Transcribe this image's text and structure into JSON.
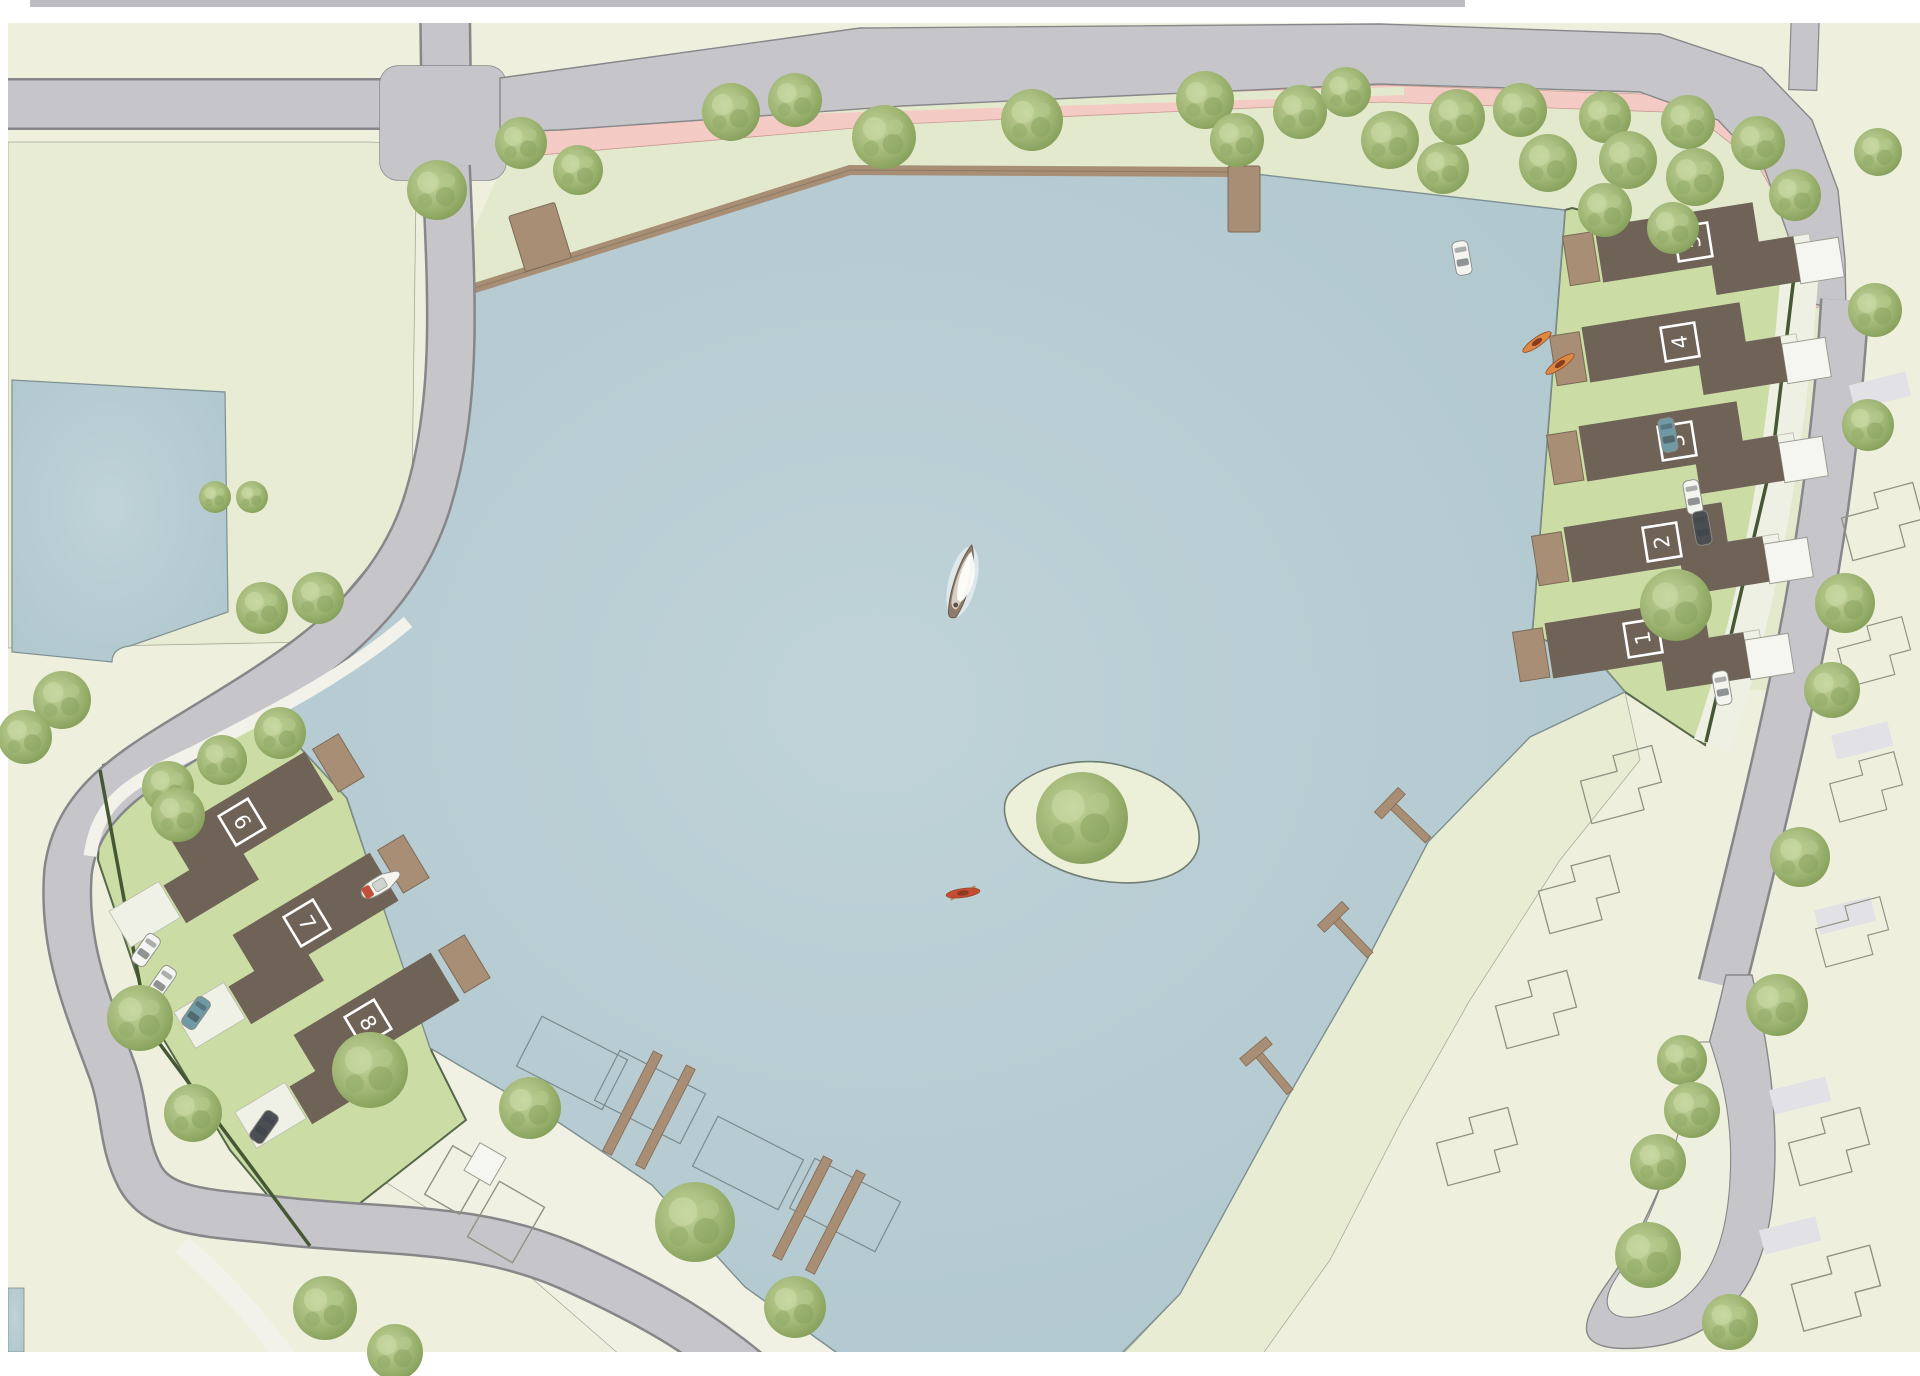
{
  "document": {
    "kind": "architectural site plan",
    "view": "top-down illustrated map of a lake-side housing development",
    "visible_text_labels": [
      "1",
      "2",
      "3",
      "4",
      "5",
      "6",
      "7",
      "8"
    ]
  },
  "palette": {
    "land_base": "#eef0dd",
    "parcel_sage": "#e8ecd4",
    "bank_green": "#e3e9cd",
    "lawn_green": "#cbdda4",
    "quay_pale": "#f0f1e3",
    "water_blue": "#b6ccd2",
    "water_edge": "#7e8f91",
    "road_gray": "#c6c5c9",
    "road_edge": "#87878a",
    "sidewalk": "#f2f2ea",
    "crosswalk": "#e2e2e6",
    "path_pink": "#f4cbc4",
    "house_dark": "#6f6358",
    "jetty_brown": "#a78e74",
    "hedge_dark": "#465833",
    "tree_green": "#9fb573"
  },
  "map": {
    "houses": [
      {
        "label": "5",
        "x": 1693,
        "y": 242,
        "rot": -9,
        "side": "right"
      },
      {
        "label": "4",
        "x": 1680,
        "y": 342,
        "rot": -9,
        "side": "right"
      },
      {
        "label": "3",
        "x": 1677,
        "y": 441,
        "rot": -9,
        "side": "right"
      },
      {
        "label": "2",
        "x": 1662,
        "y": 542,
        "rot": -9,
        "side": "right"
      },
      {
        "label": "1",
        "x": 1643,
        "y": 638,
        "rot": -9,
        "side": "right"
      },
      {
        "label": "6",
        "x": 242,
        "y": 822,
        "rot": -31,
        "side": "left"
      },
      {
        "label": "7",
        "x": 307,
        "y": 923,
        "rot": -31,
        "side": "left"
      },
      {
        "label": "8",
        "x": 368,
        "y": 1023,
        "rot": -31,
        "side": "left"
      }
    ],
    "vehicles": [
      {
        "x": 146,
        "y": 950,
        "rot": -55,
        "color": "#f4f5f1"
      },
      {
        "x": 162,
        "y": 982,
        "rot": -55,
        "color": "#f4f5f1"
      },
      {
        "x": 196,
        "y": 1013,
        "rot": -55,
        "color": "#6f9aa4"
      },
      {
        "x": 264,
        "y": 1127,
        "rot": -55,
        "color": "#4b4f54"
      },
      {
        "x": 1462,
        "y": 258,
        "rot": -100,
        "color": "#f4f5f1"
      },
      {
        "x": 1668,
        "y": 435,
        "rot": -100,
        "color": "#6f9aa4"
      },
      {
        "x": 1693,
        "y": 497,
        "rot": -100,
        "color": "#f4f5f1"
      },
      {
        "x": 1702,
        "y": 528,
        "rot": -100,
        "color": "#4b4f54"
      },
      {
        "x": 1722,
        "y": 688,
        "rot": -100,
        "color": "#f4f5f1"
      }
    ],
    "boats": {
      "sailboat": {
        "x": 963,
        "y": 580,
        "rot": 14
      },
      "motorboat": {
        "x": 381,
        "y": 884,
        "rot": -31
      },
      "kayaks": [
        {
          "x": 963,
          "y": 893,
          "rot": -8,
          "color": "#c64b33",
          "paddle": true
        },
        {
          "x": 1537,
          "y": 342,
          "rot": -35,
          "color": "#dd8840",
          "paddle": false
        },
        {
          "x": 1560,
          "y": 364,
          "rot": -35,
          "color": "#dd8840",
          "paddle": false
        }
      ]
    },
    "t_piers": [
      {
        "x": 1428,
        "y": 840,
        "rot": 224
      },
      {
        "x": 1370,
        "y": 955,
        "rot": 226
      },
      {
        "x": 1290,
        "y": 1092,
        "rot": 230
      }
    ],
    "marina_piers": [
      {
        "x": 607,
        "y": 1153,
        "rot": -63
      },
      {
        "x": 640,
        "y": 1167,
        "rot": -63
      },
      {
        "x": 777,
        "y": 1258,
        "rot": -63
      },
      {
        "x": 810,
        "y": 1272,
        "rot": -63
      }
    ],
    "berth_outlines": [
      {
        "x": 572,
        "y": 1063,
        "rot": -63
      },
      {
        "x": 650,
        "y": 1097,
        "rot": -63
      },
      {
        "x": 748,
        "y": 1163,
        "rot": -63
      },
      {
        "x": 845,
        "y": 1205,
        "rot": -63
      }
    ],
    "plot_outlines": [
      {
        "x": 1632,
        "y": 788,
        "rot": -15,
        "s": 1
      },
      {
        "x": 1590,
        "y": 898,
        "rot": -15,
        "s": 1
      },
      {
        "x": 1547,
        "y": 1013,
        "rot": -15,
        "s": 1
      },
      {
        "x": 1488,
        "y": 1150,
        "rot": -15,
        "s": 1
      },
      {
        "x": 1893,
        "y": 525,
        "rot": -15,
        "s": 1
      },
      {
        "x": 1884,
        "y": 655,
        "rot": -15,
        "s": 0.9
      },
      {
        "x": 1876,
        "y": 790,
        "rot": -15,
        "s": 0.9
      },
      {
        "x": 1862,
        "y": 935,
        "rot": -15,
        "s": 0.9
      },
      {
        "x": 1840,
        "y": 1150,
        "rot": -15,
        "s": 1
      },
      {
        "x": 1848,
        "y": 1292,
        "rot": -15,
        "s": 1.1
      },
      {
        "x": 350,
        "y": 690,
        "rot": 20,
        "s": 0.0
      }
    ],
    "trees": [
      [
        437,
        190,
        30
      ],
      [
        521,
        143,
        26
      ],
      [
        578,
        170,
        25
      ],
      [
        731,
        112,
        29
      ],
      [
        795,
        100,
        27
      ],
      [
        884,
        137,
        32
      ],
      [
        1032,
        120,
        31
      ],
      [
        1205,
        100,
        29
      ],
      [
        1237,
        140,
        27
      ],
      [
        1300,
        112,
        27
      ],
      [
        1346,
        92,
        25
      ],
      [
        1390,
        140,
        29
      ],
      [
        1443,
        168,
        26
      ],
      [
        1457,
        117,
        28
      ],
      [
        1520,
        110,
        27
      ],
      [
        1548,
        163,
        29
      ],
      [
        1605,
        117,
        26
      ],
      [
        1628,
        160,
        29
      ],
      [
        1688,
        122,
        27
      ],
      [
        1695,
        177,
        29
      ],
      [
        1758,
        143,
        27
      ],
      [
        1795,
        195,
        26
      ],
      [
        1878,
        152,
        24
      ],
      [
        1605,
        210,
        27
      ],
      [
        1673,
        228,
        26
      ],
      [
        215,
        497,
        16
      ],
      [
        252,
        497,
        16
      ],
      [
        318,
        598,
        26
      ],
      [
        262,
        608,
        26
      ],
      [
        280,
        733,
        26
      ],
      [
        222,
        760,
        25
      ],
      [
        168,
        787,
        26
      ],
      [
        62,
        700,
        29
      ],
      [
        25,
        737,
        27
      ],
      [
        178,
        815,
        27
      ],
      [
        140,
        1018,
        33
      ],
      [
        193,
        1113,
        29
      ],
      [
        370,
        1070,
        38
      ],
      [
        530,
        1108,
        31
      ],
      [
        695,
        1222,
        40
      ],
      [
        795,
        1307,
        31
      ],
      [
        325,
        1308,
        32
      ],
      [
        395,
        1352,
        28
      ],
      [
        1082,
        818,
        46
      ],
      [
        1676,
        605,
        36
      ],
      [
        1875,
        310,
        27
      ],
      [
        1868,
        425,
        26
      ],
      [
        1845,
        603,
        30
      ],
      [
        1832,
        690,
        28
      ],
      [
        1800,
        857,
        30
      ],
      [
        1777,
        1005,
        31
      ],
      [
        1682,
        1060,
        25
      ],
      [
        1692,
        1110,
        28
      ],
      [
        1658,
        1162,
        28
      ],
      [
        1648,
        1255,
        33
      ],
      [
        1730,
        1322,
        28
      ]
    ]
  }
}
